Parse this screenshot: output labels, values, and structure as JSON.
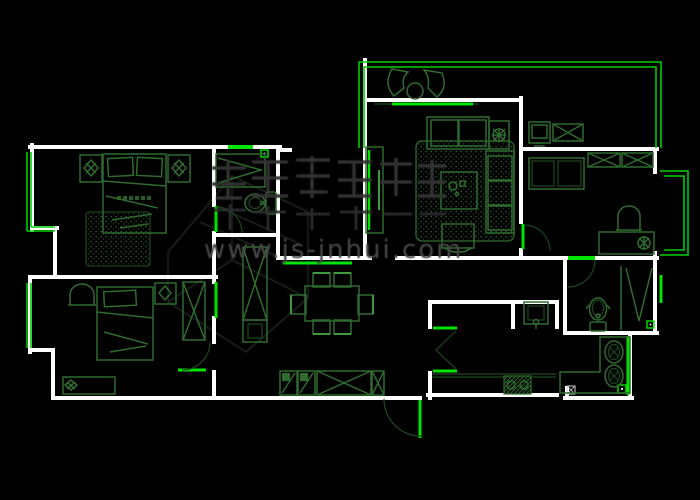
{
  "document": {
    "type": "apartment-floor-plan-cad-drawing",
    "background": "#000000"
  },
  "watermark": {
    "url_text": "www.js-jnhui.com",
    "logo": "large gray calligraphic logo glyphs"
  },
  "colors": {
    "wall_white": "#ffffff",
    "opening_bright_green": "#00dd00",
    "furniture_green": "#2f6b2f",
    "furniture_dark_green": "#1e481e",
    "rug_dot_green": "#2a5c2a",
    "watermark_gray": "#3a3a3a"
  },
  "rooms": [
    {
      "name": "master-bedroom",
      "fixtures": [
        "double-bed",
        "pillows",
        "nightstand-lamps",
        "dotted-rug"
      ]
    },
    {
      "name": "master-bathroom",
      "fixtures": [
        "wardrobe-v-symbol",
        "toilet",
        "door-arc"
      ]
    },
    {
      "name": "second-bedroom",
      "fixtures": [
        "single-bed",
        "nightstand",
        "x-wardrobe",
        "dresser",
        "arch-chair",
        "door-arc"
      ]
    },
    {
      "name": "hallway",
      "fixtures": [
        "x-cabinet",
        "shoe-cabinets",
        "storage-x-boxes"
      ]
    },
    {
      "name": "dining-area",
      "fixtures": [
        "dining-table",
        "six-chairs"
      ]
    },
    {
      "name": "living-room",
      "fixtures": [
        "sofa",
        "side-sofa",
        "coffee-table",
        "armchair",
        "plant-table",
        "dotted-rug",
        "tv-unit"
      ]
    },
    {
      "name": "north-balcony",
      "fixtures": [
        "fan-chairs",
        "round-table",
        "sliding-door"
      ]
    },
    {
      "name": "east-bedroom",
      "fixtures": [
        "bench-seat",
        "x-wardrobes",
        "desk",
        "chair",
        "plant",
        "door-arc"
      ]
    },
    {
      "name": "east-balcony",
      "fixtures": []
    },
    {
      "name": "bathroom",
      "fixtures": [
        "toilet",
        "shower-v-symbol",
        "door-arc",
        "window"
      ]
    },
    {
      "name": "washroom",
      "fixtures": [
        "l-shaped-vanity",
        "double-basins"
      ]
    },
    {
      "name": "kitchen",
      "fixtures": [
        "counter",
        "gas-stove",
        "sink",
        "bifold-door"
      ]
    },
    {
      "name": "entry",
      "fixtures": [
        "entry-door-arc",
        "door-leaf"
      ]
    }
  ]
}
